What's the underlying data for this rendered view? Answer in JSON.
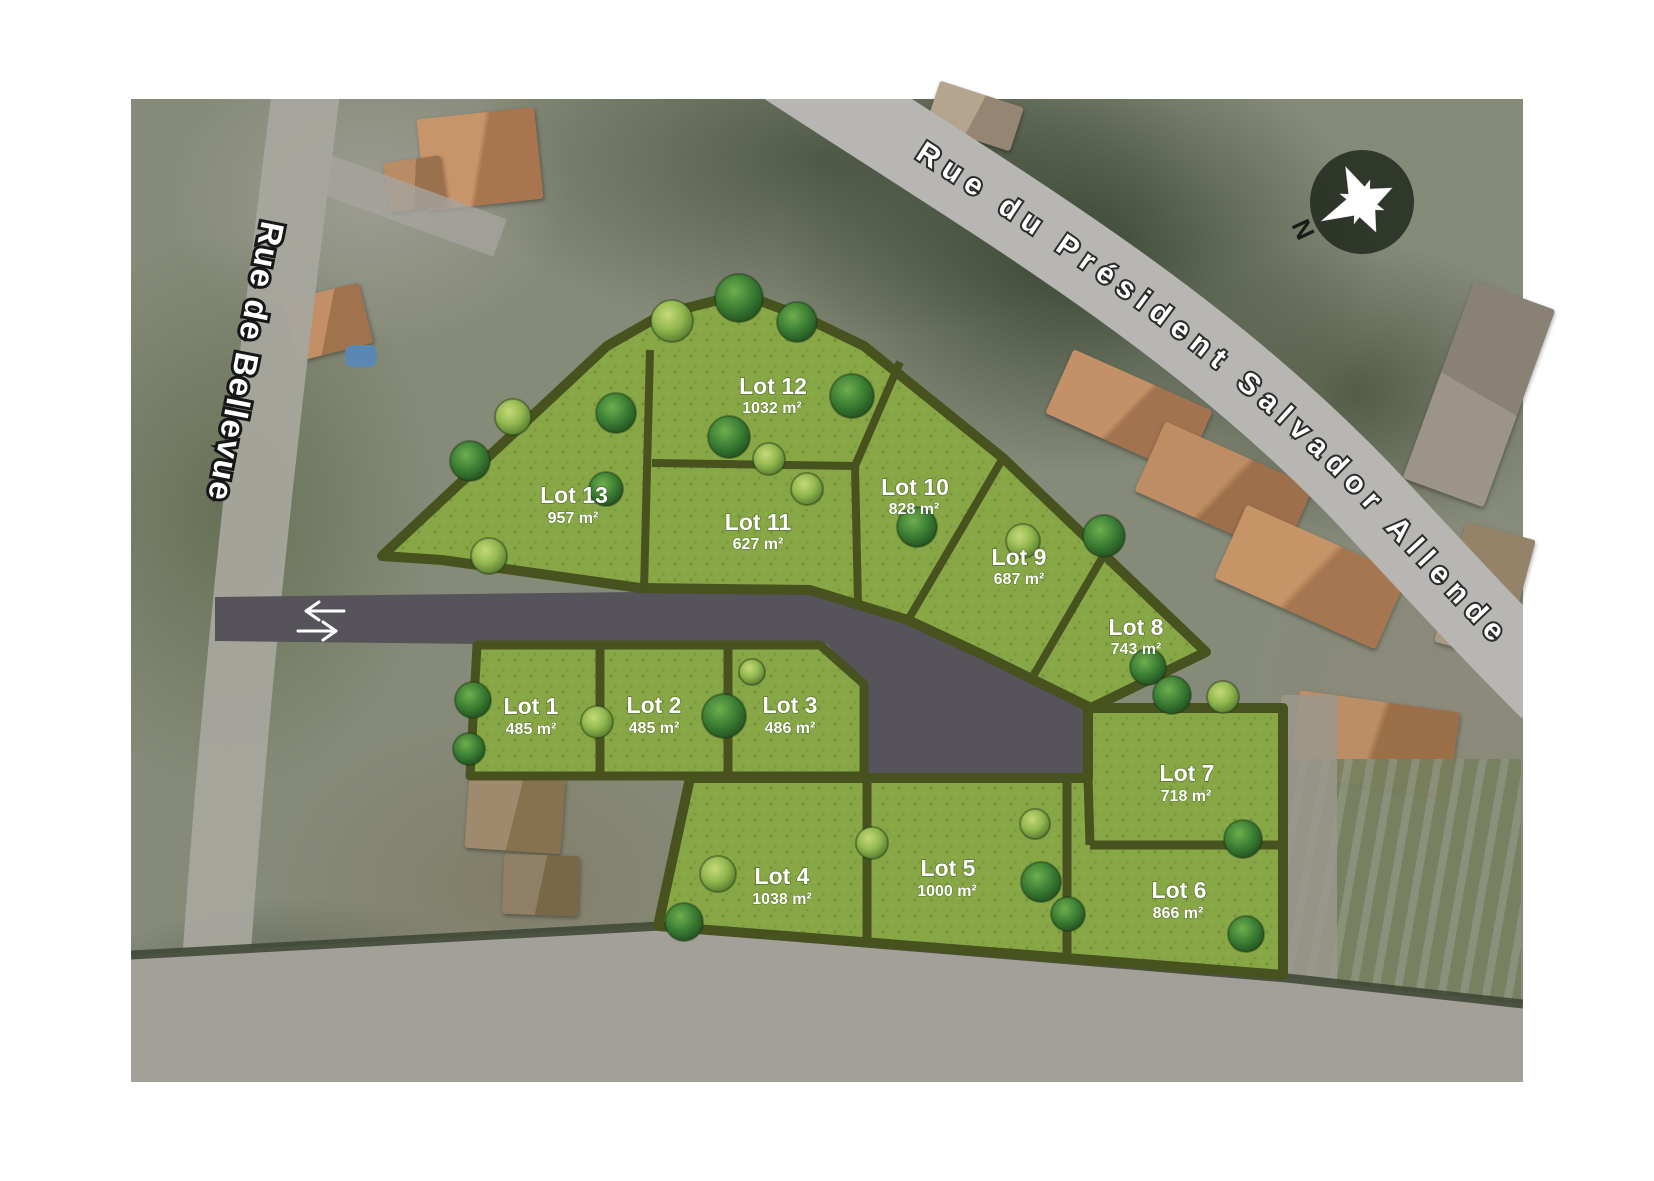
{
  "plan": {
    "streets": {
      "left_road_label": "Rue de Bellevue",
      "top_road_label": "Rue du Président Salvador Allende"
    },
    "compass": {
      "north_label": "N"
    },
    "icons": {
      "compass": "compass-rose-icon",
      "access_arrows": "two-way-arrows-icon"
    },
    "colors": {
      "lot_fill": "#87a746",
      "hedge": "#47521f",
      "access_road": "#56535a",
      "street_band": "#b7b6b3",
      "label_text": "#ffffff"
    },
    "lots": [
      {
        "name": "Lot 1",
        "area": "485 m²"
      },
      {
        "name": "Lot 2",
        "area": "485 m²"
      },
      {
        "name": "Lot 3",
        "area": "486 m²"
      },
      {
        "name": "Lot 4",
        "area": "1038 m²"
      },
      {
        "name": "Lot 5",
        "area": "1000 m²"
      },
      {
        "name": "Lot 6",
        "area": "866 m²"
      },
      {
        "name": "Lot 7",
        "area": "718 m²"
      },
      {
        "name": "Lot 8",
        "area": "743 m²"
      },
      {
        "name": "Lot 9",
        "area": "687 m²"
      },
      {
        "name": "Lot 10",
        "area": "828 m²"
      },
      {
        "name": "Lot 11",
        "area": "627 m²"
      },
      {
        "name": "Lot 12",
        "area": "1032 m²"
      },
      {
        "name": "Lot 13",
        "area": "957 m²"
      }
    ]
  }
}
